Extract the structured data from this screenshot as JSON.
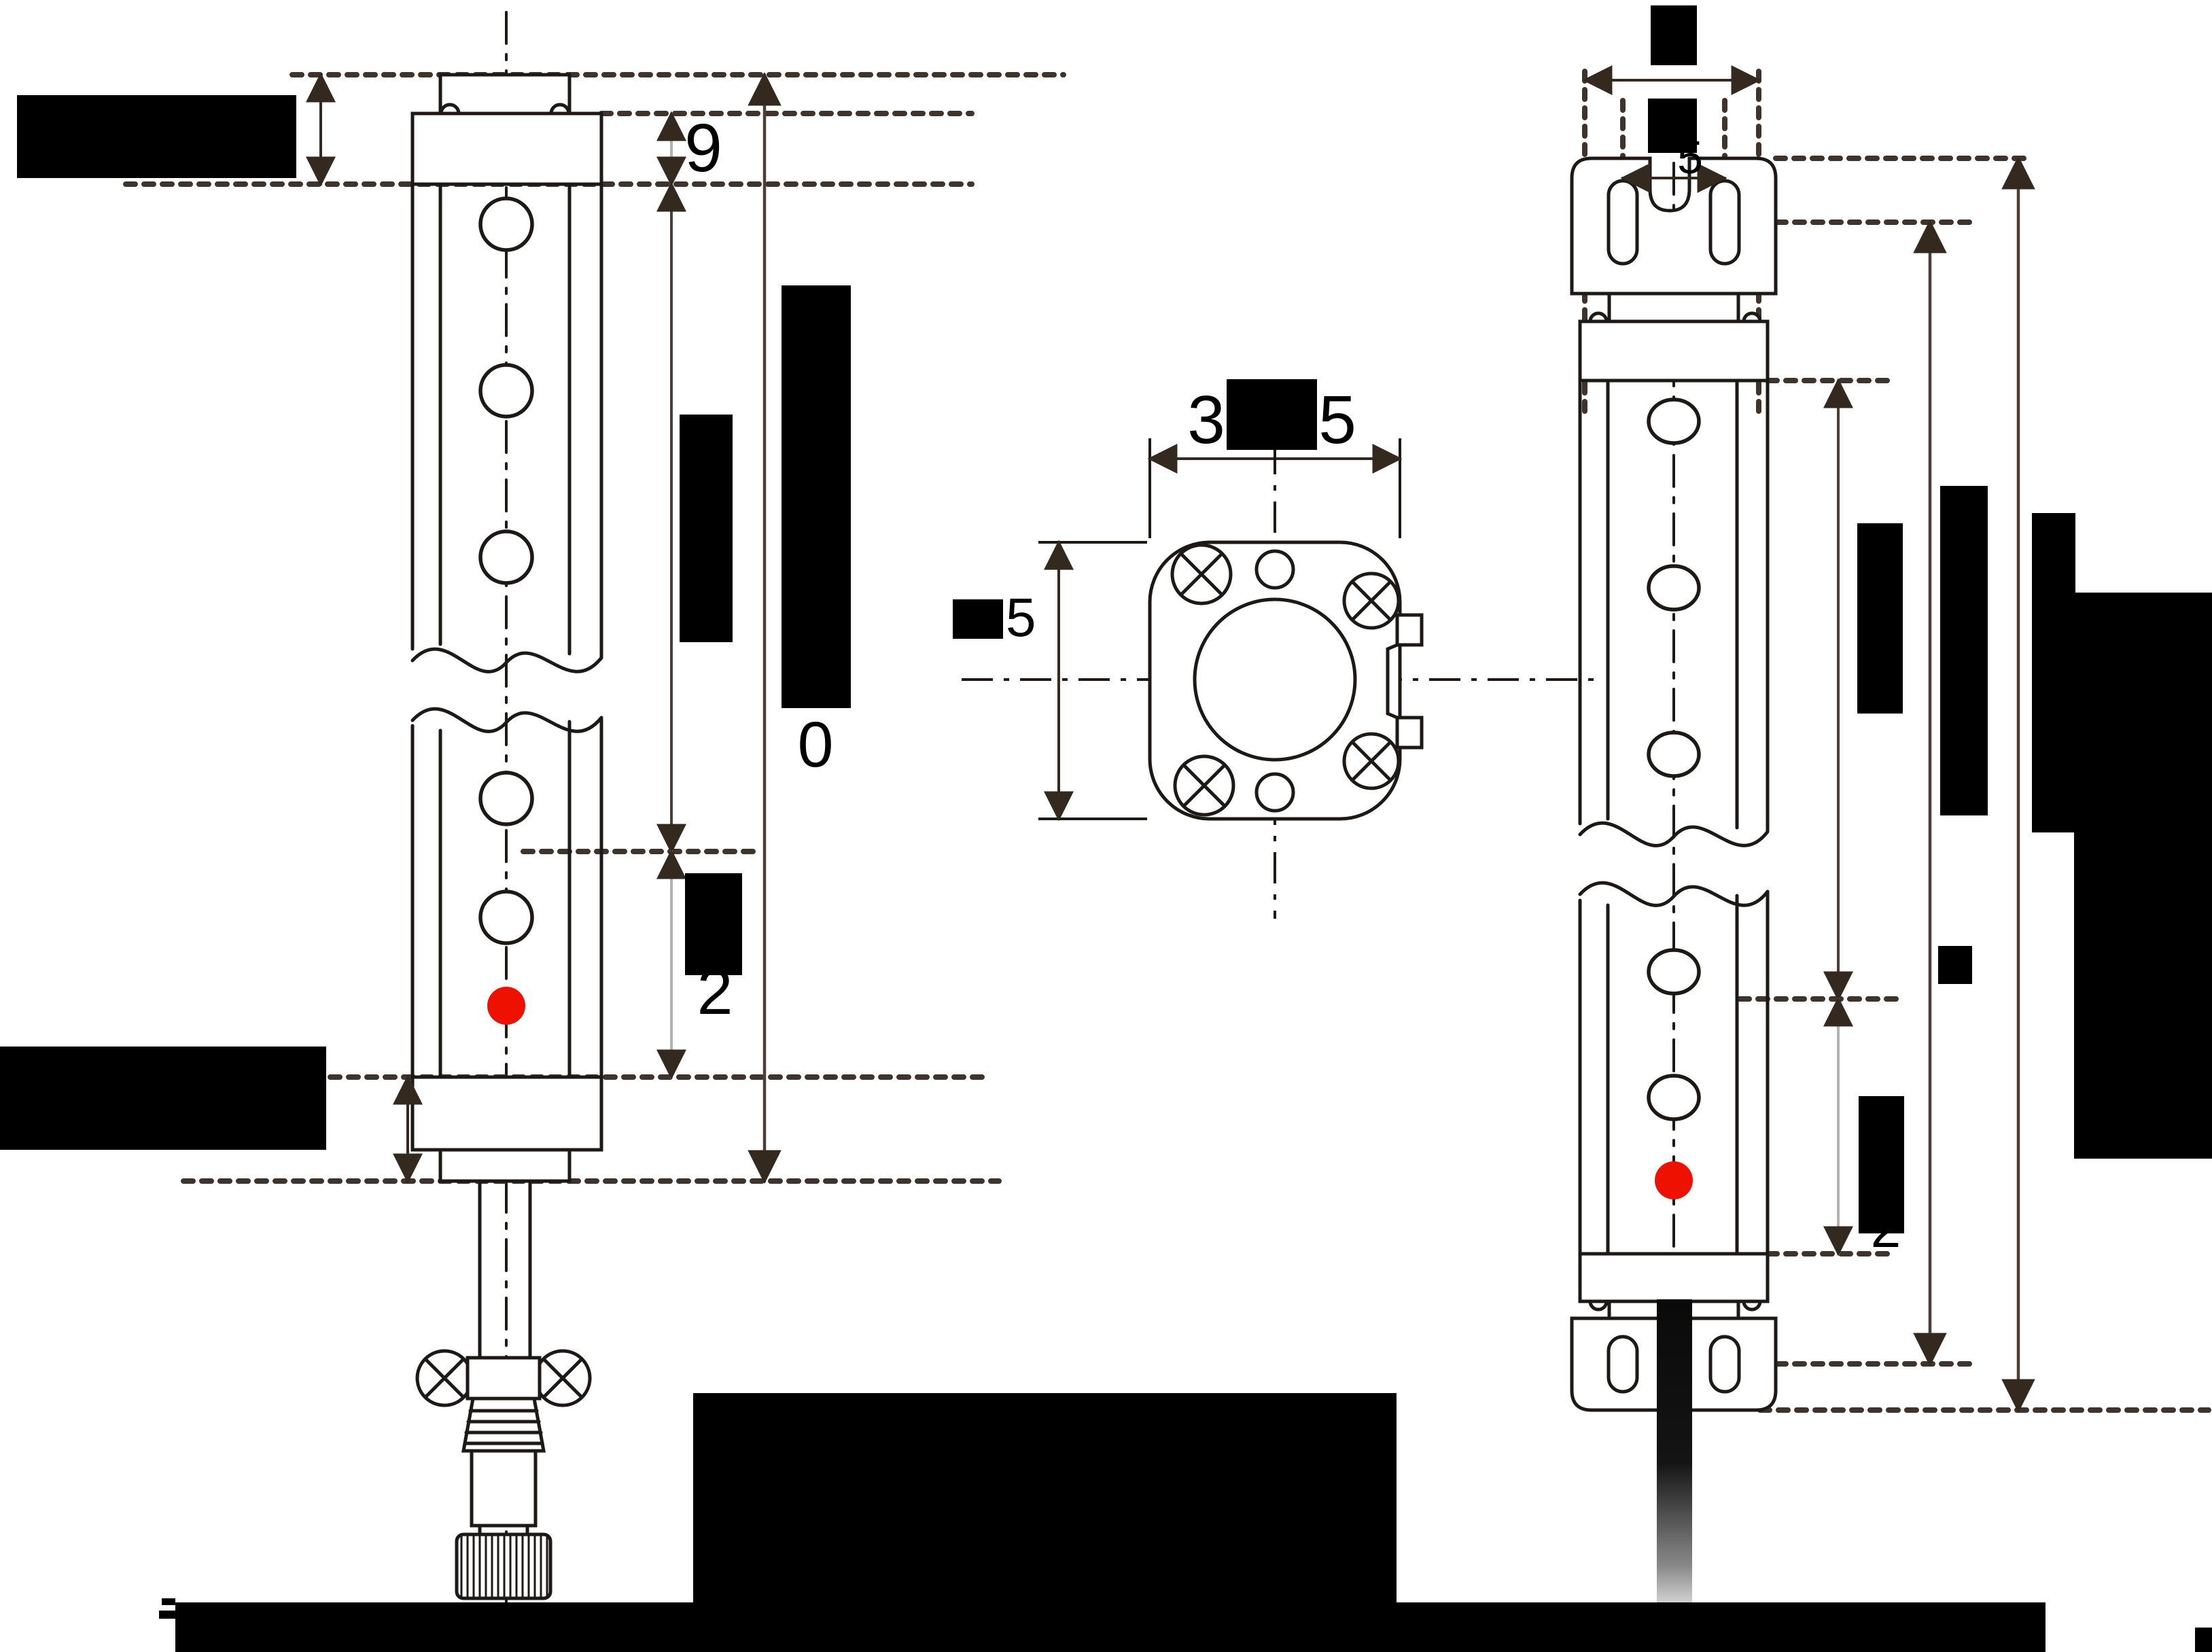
{
  "title": "light-curtain-dimension-drawing",
  "colors": {
    "ink": "#1c1917",
    "dim": "#4a3e36",
    "dashed": "#3f342c",
    "thin_dim": "#b3b3b3",
    "red_led": "#ee1000",
    "redaction": "#000000"
  },
  "labels": {
    "front_cap_height": "9",
    "front_lower_zone": "2",
    "front_total": "0",
    "section_width_prefix": "3",
    "section_width_suffix": "5",
    "section_height": "5",
    "rear_hole_pitch": "5",
    "rear_lower_zone": "2"
  }
}
